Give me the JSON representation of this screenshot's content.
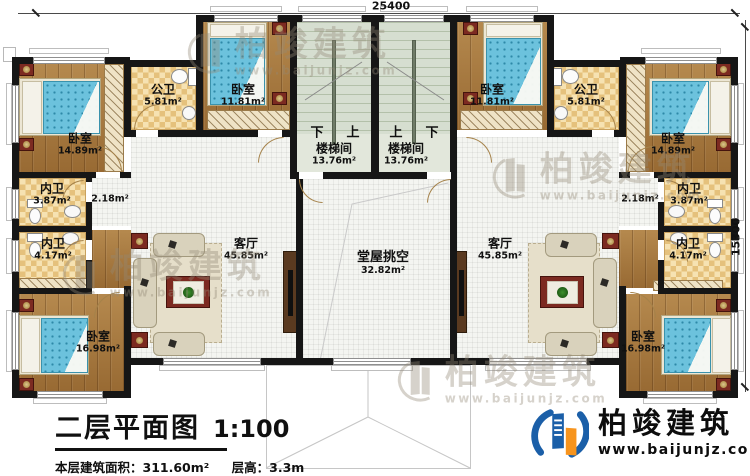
{
  "plan": {
    "dim_top": "25400",
    "dim_right": "15300"
  },
  "rooms": [
    {
      "label": "卧室",
      "area": "14.89m²"
    },
    {
      "label": "公卫",
      "area": "5.81m²"
    },
    {
      "label": "卧室",
      "area": "11.81m²"
    },
    {
      "label": "楼梯间",
      "area": "13.76m²"
    },
    {
      "label": "楼梯间",
      "area": "13.76m²"
    },
    {
      "label": "卧室",
      "area": "11.81m²"
    },
    {
      "label": "公卫",
      "area": "5.81m²"
    },
    {
      "label": "卧室",
      "area": "14.89m²"
    },
    {
      "label": "内卫",
      "area": "3.87m²"
    },
    {
      "label": "",
      "area": "2.18m²"
    },
    {
      "label": "内卫",
      "area": "4.17m²"
    },
    {
      "label": "内卫",
      "area": "3.87m²"
    },
    {
      "label": "",
      "area": "2.18m²"
    },
    {
      "label": "内卫",
      "area": "4.17m²"
    },
    {
      "label": "卧室",
      "area": "16.98m²"
    },
    {
      "label": "客厅",
      "area": "45.85m²"
    },
    {
      "label": "堂屋挑空",
      "area": "32.82m²"
    },
    {
      "label": "客厅",
      "area": "45.85m²"
    },
    {
      "label": "卧室",
      "area": "16.98m²"
    }
  ],
  "stairs": {
    "left_down": "下",
    "left_up": "上",
    "right_up": "上",
    "right_down": "下"
  },
  "title": {
    "name": "二层平面图",
    "scale": "1:100",
    "area_label": "本层建筑面积：",
    "area_value": "311.60m²",
    "floor_height_label": "层高：",
    "floor_height_value": "3.3m"
  },
  "brand": {
    "name": "柏竣建筑",
    "site": "www.baijunjz.com"
  },
  "watermark": {
    "name": "柏竣建筑",
    "site": "www.baijunjz.com"
  }
}
